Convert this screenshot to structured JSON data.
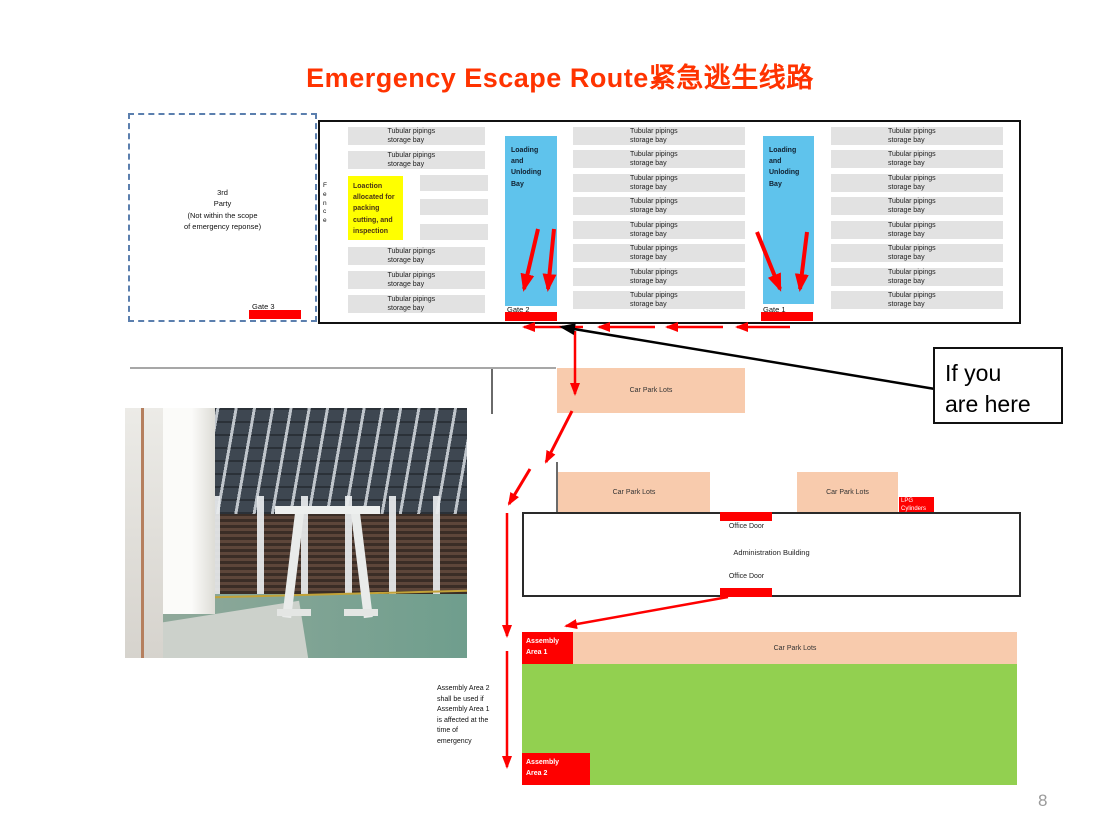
{
  "slide": {
    "title": "Emergency Escape Route紧急逃生线路",
    "page_number": "8"
  },
  "third_party": {
    "text": "3rd\nParty\n(Not within the scope\nof emergency reponse)",
    "gate_label": "Gate 3"
  },
  "building": {
    "fence_vertical": "F\ne\nn\nc\ne",
    "storage_bay_label": "Tubular pipings storage bay",
    "yellow_note": "Loaction allocated for packing cutting, and inspection",
    "loading_bay_label": "Loading\nand\nUnloding\nBay",
    "gate1_label": "Gate 1",
    "gate2_label": "Gate 2"
  },
  "site": {
    "here_label": "If you\nare here",
    "car_park_label": "Car Park Lots",
    "lpg_label": "LPG\nCylinders",
    "office_door_label": "Office Door",
    "admin_label": "Administration Building",
    "assembly1_label": "Assembly\nArea 1",
    "assembly2_label": "Assembly\nArea 2",
    "assembly_note": "Assembly Area 2\nshall be used if\nAssembly Area 1\nis affected at the\ntime of\nemergency"
  },
  "colors": {
    "title_red": "#ff3300",
    "marker_red": "#fe0000",
    "bay_gray": "#e2e2e2",
    "loading_blue": "#5fc3ec",
    "note_yellow": "#ffff00",
    "carpark_peach": "#f8cbad",
    "assembly_green": "#92d050"
  }
}
